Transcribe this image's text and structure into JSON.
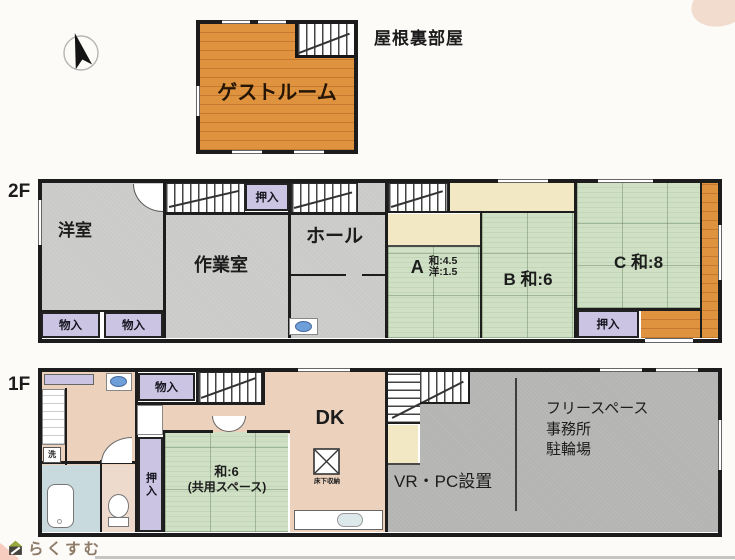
{
  "attic": {
    "floor_title": "屋根裏部屋",
    "guest_room_label": "ゲストルーム"
  },
  "floor2": {
    "floor_label": "2F",
    "western_room": "洋室",
    "work_room": "作業室",
    "hall": "ホール",
    "closet_top": "押入",
    "closet_bottom": "押入",
    "storage_left": "物入",
    "storage_right": "物入",
    "room_a_letter": "A",
    "room_a_wa": "和:4.5",
    "room_a_yo": "洋:1.5",
    "room_b": "B 和:6",
    "room_c": "C 和:8"
  },
  "floor1": {
    "floor_label": "1F",
    "storage": "物入",
    "dk": "DK",
    "tatami_line1": "和:6",
    "tatami_line2": "(共用スペース)",
    "closet_vertical": "押入",
    "underfloor_storage": "床下収納",
    "laundry": "洗",
    "free_space": "フリースペース",
    "office": "事務所",
    "bicycle_parking": "駐輪場",
    "vr_pc": "VR・PC設置"
  },
  "footer": {
    "brand": "らくすむ"
  },
  "icons": {
    "compass": "north-arrow-icon",
    "washbasin": "sink-icon",
    "kitchen_sink": "kitchen-sink-icon",
    "toilet": "toilet-icon",
    "bathtub": "bathtub-icon",
    "underfloor": "underfloor-storage-icon",
    "logo": "house-logo-icon"
  },
  "colors": {
    "wood_orange": "#e0933f",
    "tatami_green": "#cfe0c5",
    "closet_purple": "#cbc4e2",
    "gray_room_2f": "#cacac8",
    "gray_room_1f": "#b4b4b2",
    "dk_tan": "#ecd2bd",
    "bath_blue": "#c9dade",
    "wall": "#1d1d1d"
  }
}
